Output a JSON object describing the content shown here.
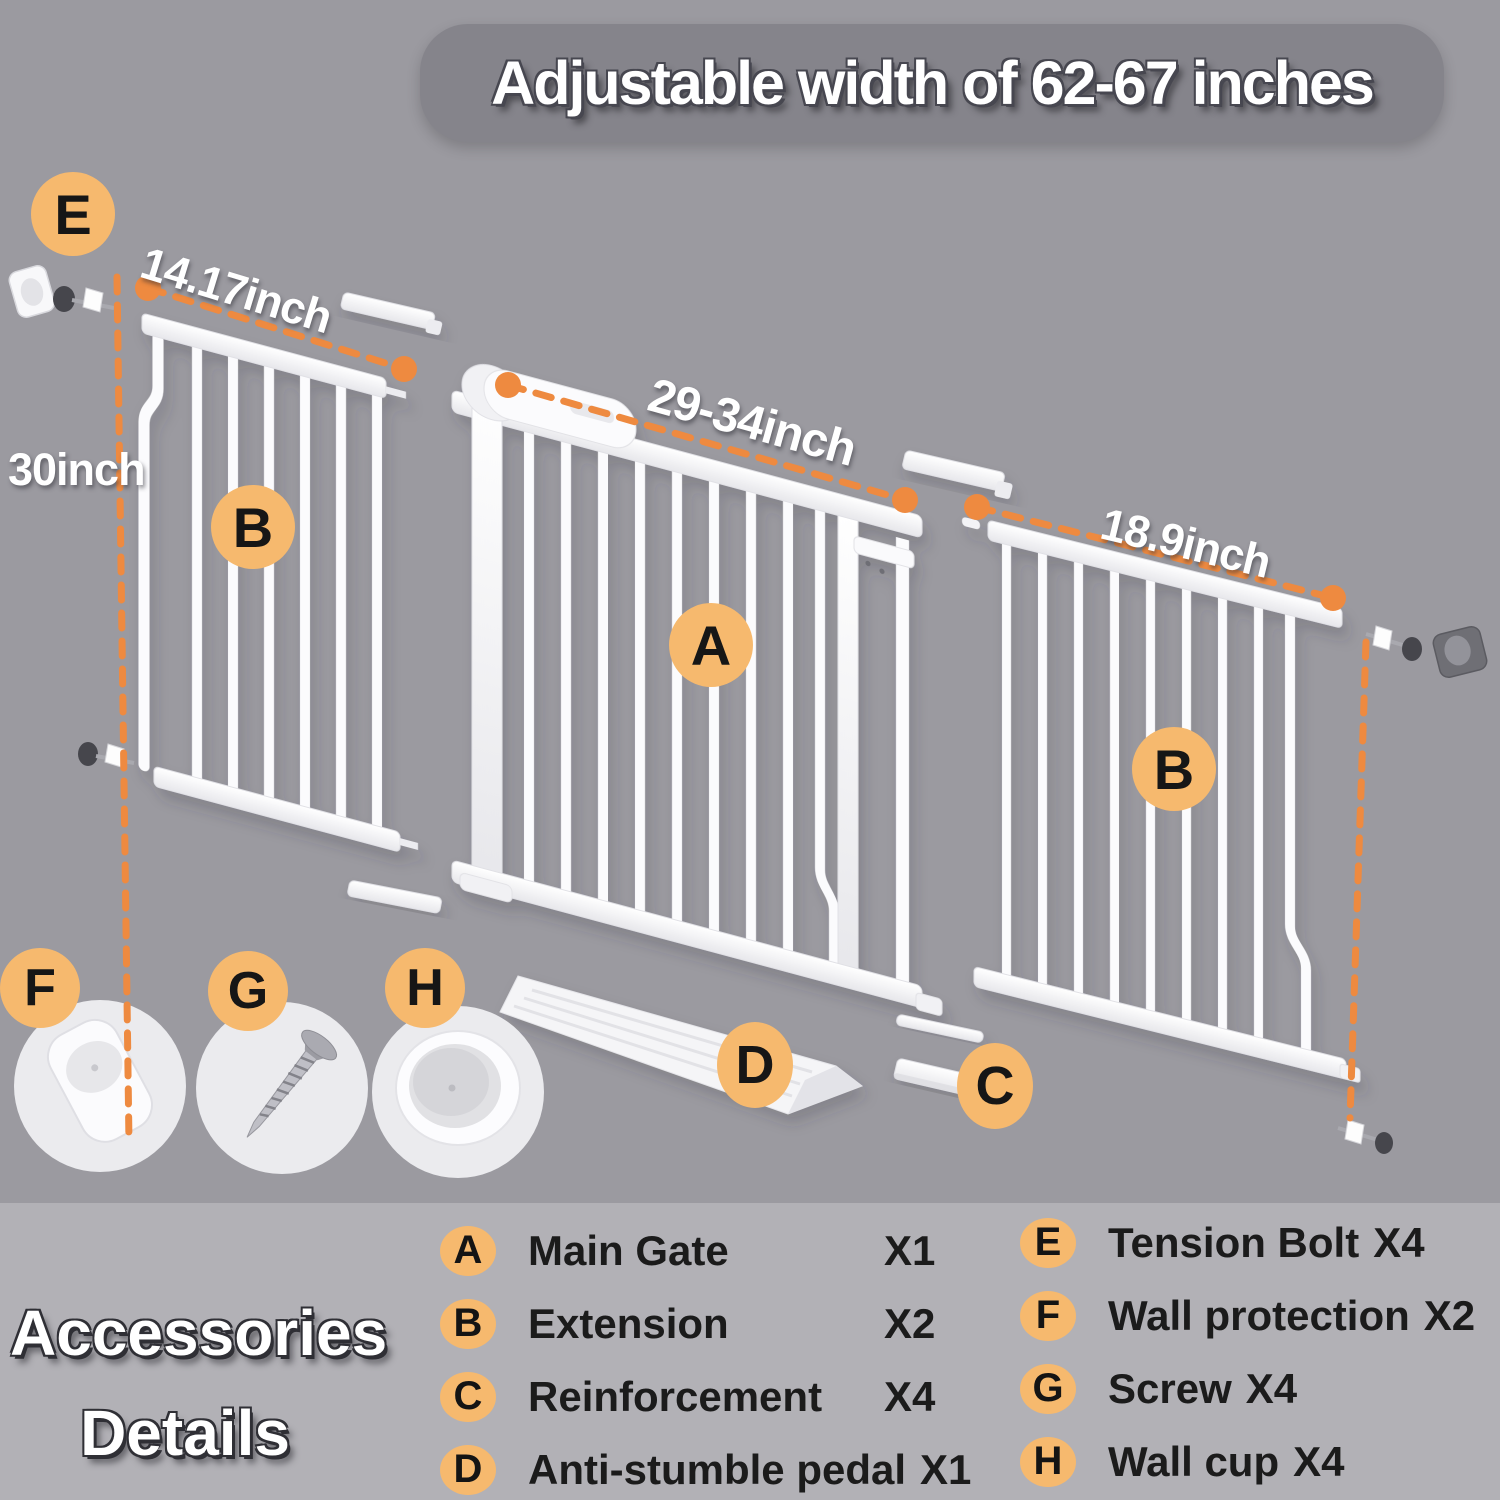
{
  "banner": {
    "title": "Adjustable width of 62-67 inches"
  },
  "measurements": {
    "extension_left_width": "14.17inch",
    "gate_height": "30inch",
    "main_gate_width": "29-34inch",
    "extension_right_width": "18.9inch"
  },
  "parts": {
    "a": "A",
    "b": "B",
    "c": "C",
    "d": "D",
    "e": "E",
    "f": "F",
    "g": "G",
    "h": "H"
  },
  "legend": {
    "title_line1": "Accessories",
    "title_line2": "Details",
    "left_items": [
      {
        "key": "A",
        "name": "Main Gate",
        "count": "X1"
      },
      {
        "key": "B",
        "name": "Extension",
        "count": "X2"
      },
      {
        "key": "C",
        "name": "Reinforcement",
        "count": "X4"
      },
      {
        "key": "D",
        "name": "Anti-stumble pedal",
        "count": "X1"
      }
    ],
    "right_items": [
      {
        "key": "E",
        "name": "Tension Bolt",
        "count": "X4"
      },
      {
        "key": "F",
        "name": "Wall protection",
        "count": "X2"
      },
      {
        "key": "G",
        "name": "Screw",
        "count": "X4"
      },
      {
        "key": "H",
        "name": "Wall cup",
        "count": "X4"
      }
    ]
  },
  "colors": {
    "background": "#9b9aa0",
    "legend_panel": "#b2b1b6",
    "banner_bg": "#85848b",
    "accent_circle": "#f6b96e",
    "dash_orange": "#ee8a40",
    "gate_white": "#ffffff",
    "text_dark": "#1b1b1b"
  }
}
